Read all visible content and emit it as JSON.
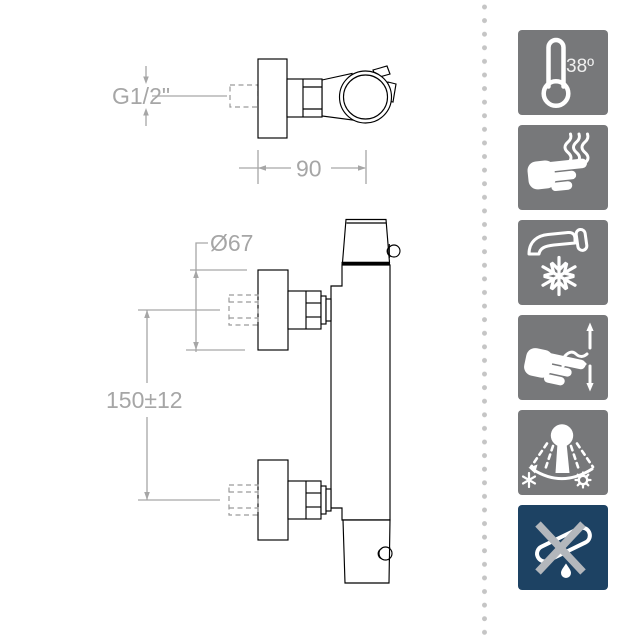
{
  "drawing": {
    "top_view": {
      "thread_label": "G1/2\"",
      "width_label": "90"
    },
    "front_view": {
      "diameter_label": "Ø67",
      "spacing_label": "150±12"
    }
  },
  "features": [
    {
      "name": "max-temperature",
      "icon": "thermometer-icon",
      "label": "38º"
    },
    {
      "name": "cool-touch-body",
      "icon": "hand-heat-icon"
    },
    {
      "name": "cold-water-opening",
      "icon": "faucet-snowflake-icon"
    },
    {
      "name": "flow-control",
      "icon": "hand-flow-arrows-icon"
    },
    {
      "name": "adjustable-spray-temperature",
      "icon": "shower-spray-icon"
    },
    {
      "name": "no-spout",
      "icon": "crossed-spout-icon"
    }
  ],
  "colors": {
    "tile_gray": "#77787a",
    "tile_navy": "#1d4263",
    "dimension_gray": "#a6a6a6",
    "dot_gray": "#c5c5c5",
    "line_black": "#000000",
    "icon_white": "#ffffff",
    "cross_gray": "#b3b7bc"
  }
}
